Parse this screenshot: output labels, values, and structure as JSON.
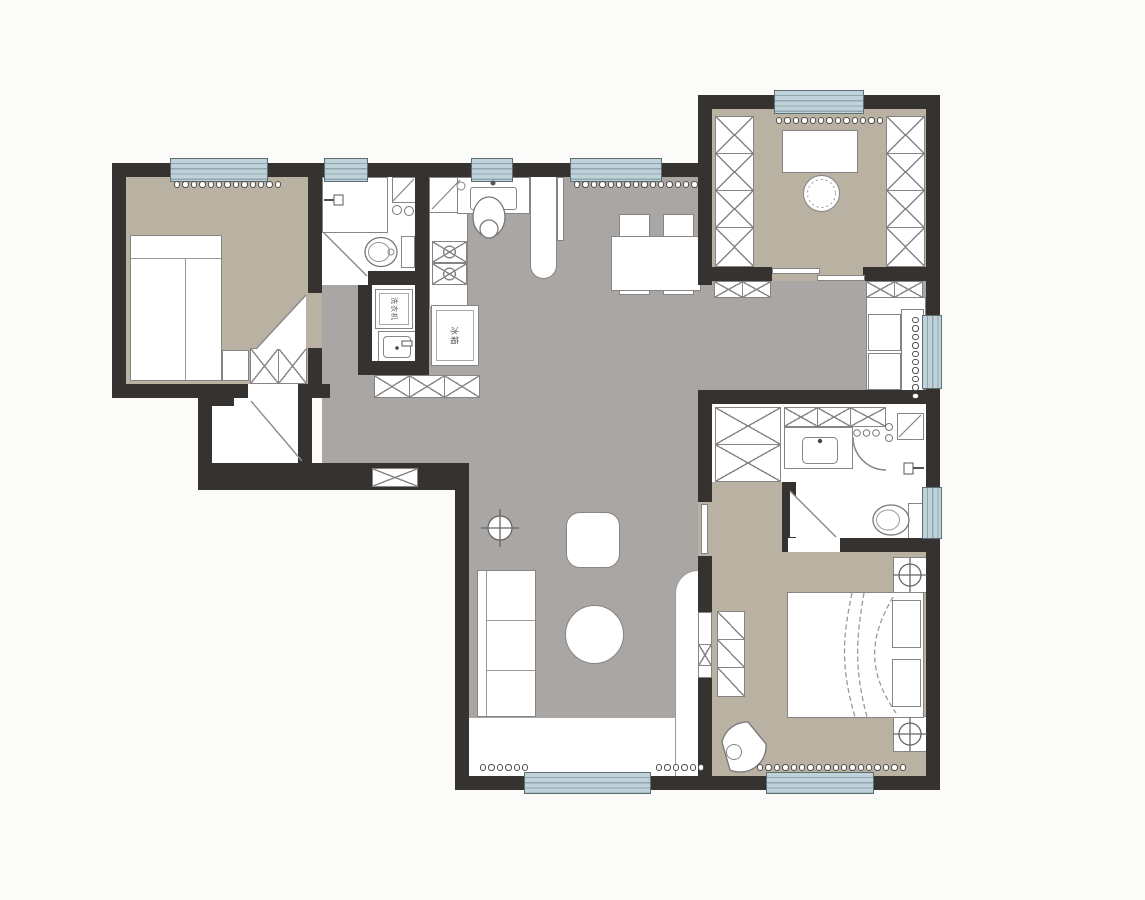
{
  "canvas": {
    "width": 1145,
    "height": 900
  },
  "palette": {
    "page_bg": "#fbfbfa",
    "wall": "#363230",
    "floor_main": "#a9a6a3",
    "floor_room": "#b9b1a2",
    "window_fill": "#c0d2d9",
    "window_line": "#8fa6b0",
    "fixture_outline": "#858585",
    "door_line": "#8a8a8a",
    "label_text": "#5f5b56"
  },
  "labels": {
    "washing_machine": "洗衣机",
    "refrigerator": "冰箱"
  }
}
